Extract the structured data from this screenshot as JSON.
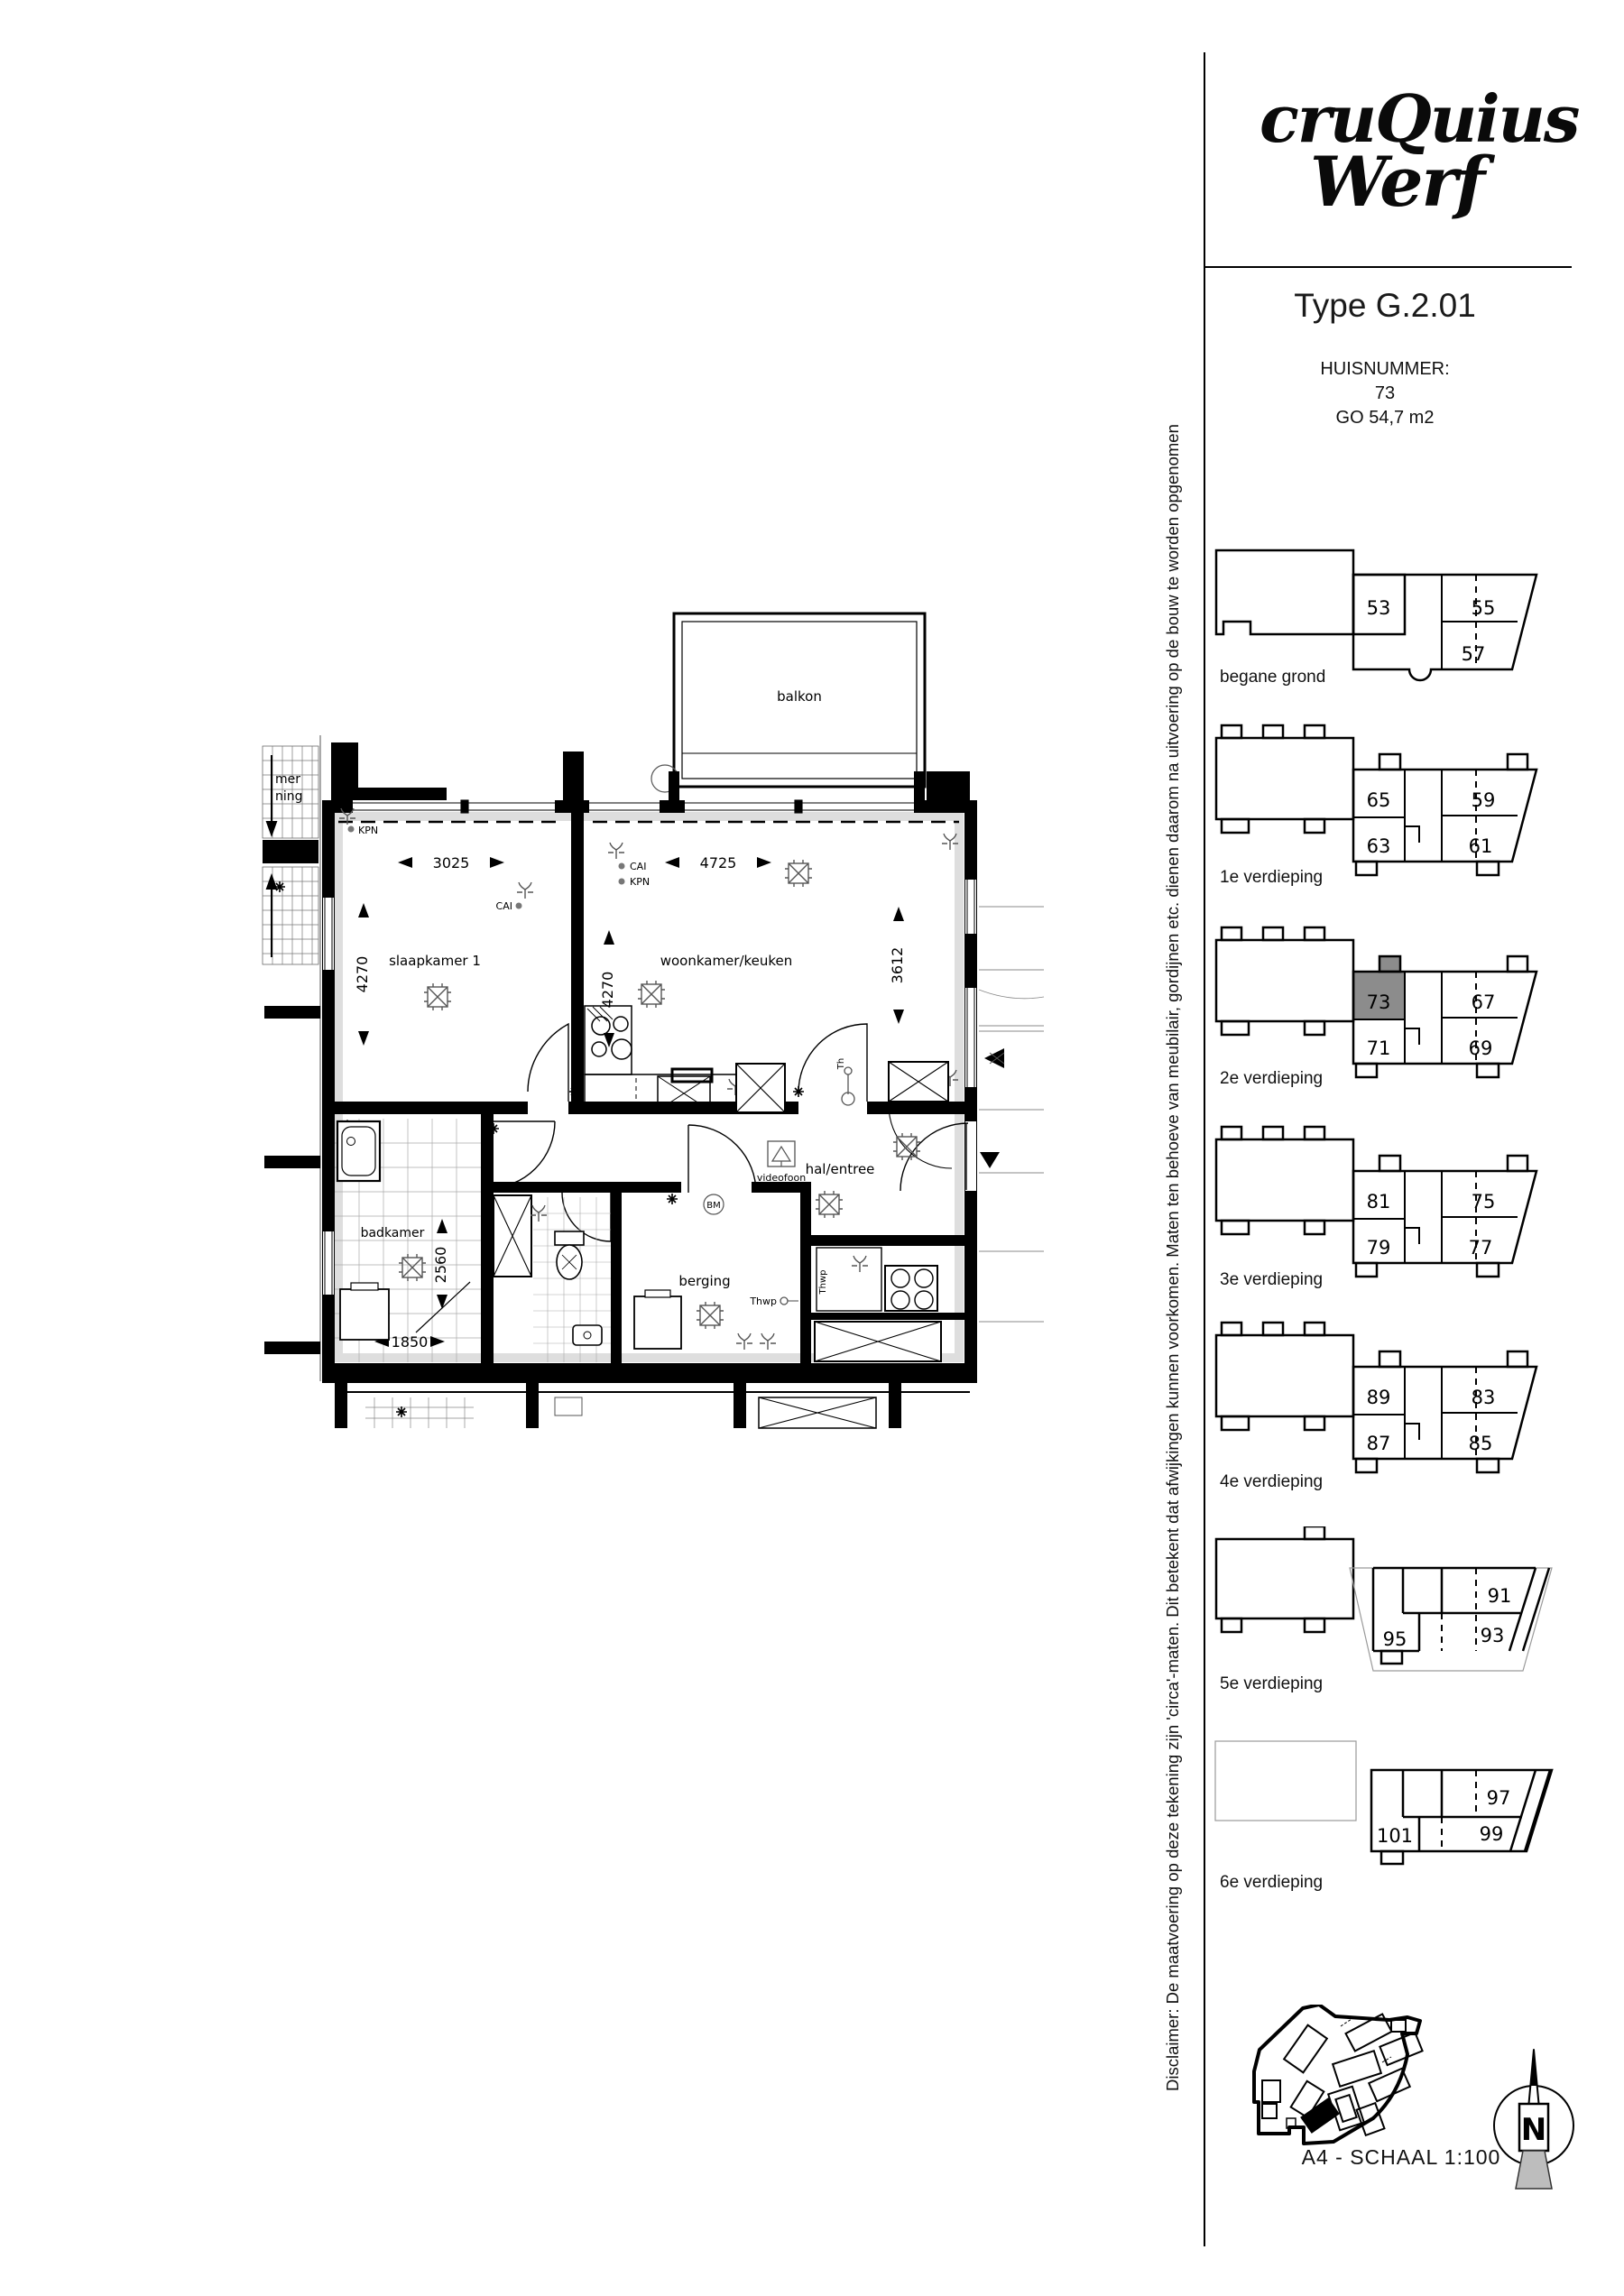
{
  "header": {
    "logo_line1": "cruQuius",
    "logo_line2": "Werf",
    "type_title": "Type G.2.01",
    "huisnummer_label": "HUISNUMMER:",
    "huisnummer": "73",
    "go_label": "GO 54,7 m2"
  },
  "plan": {
    "rooms": {
      "balkon": "balkon",
      "slaapkamer": "slaapkamer 1",
      "woonkamer": "woonkamer/keuken",
      "badkamer": "badkamer",
      "berging": "berging",
      "hal": "hal/entree"
    },
    "dimensions": {
      "slaapkamer_breedte": "3025",
      "woonkamer_breedte": "4725",
      "slaapkamer_diepte": "4270",
      "woonkamer_diepte": "4270",
      "woonkamer_rechts": "3612",
      "badkamer_diepte": "2560",
      "badkamer_breedte": "1850"
    },
    "annotations": {
      "kpn": "KPN",
      "cai": "CAI",
      "cai2": "CAI",
      "kpn2": "KPN",
      "videofoon": "videofoon",
      "bm": "BM",
      "th": "Th",
      "thwp": "Thwp",
      "thwp2": "Thwp",
      "neighbor_text_1": "mer",
      "neighbor_text_2": "ning"
    }
  },
  "sidebar": {
    "disclaimer": "Disclaimer: De maatvoering op deze tekening zijn 'circa'-maten. Dit betekent dat afwijkingen kunnen voorkomen. Maten ten behoeve van meubilair, gordijnen etc. dienen daarom na uitvoering op de bouw te worden opgenomen",
    "highlight_color": "#8c8c8c",
    "highlight_unit": "73",
    "levels": [
      {
        "label": "begane grond",
        "units": [
          "53",
          "55",
          "57"
        ]
      },
      {
        "label": "1e verdieping",
        "units": [
          "65",
          "63",
          "59",
          "61"
        ]
      },
      {
        "label": "2e verdieping",
        "units": [
          "73",
          "71",
          "67",
          "69"
        ]
      },
      {
        "label": "3e verdieping",
        "units": [
          "81",
          "79",
          "75",
          "77"
        ]
      },
      {
        "label": "4e verdieping",
        "units": [
          "89",
          "87",
          "83",
          "85"
        ]
      },
      {
        "label": "5e verdieping",
        "units": [
          "95",
          "91",
          "93"
        ]
      },
      {
        "label": "6e verdieping",
        "units": [
          "101",
          "97",
          "99"
        ]
      }
    ],
    "footer": {
      "scale": "A4 - SCHAAL 1:100",
      "north": "N"
    }
  }
}
